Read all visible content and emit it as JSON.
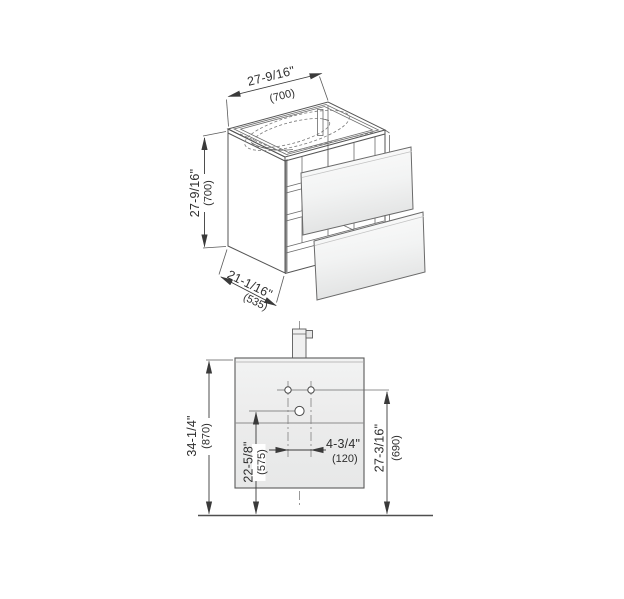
{
  "drawing": {
    "kind": "vanity-unit-technical-drawing",
    "views": {
      "isometric": {
        "width": {
          "inch": "27-9/16\"",
          "mm": "(700)"
        },
        "height": {
          "inch": "27-9/16\"",
          "mm": "(700)"
        },
        "depth": {
          "inch": "21-1/16\"",
          "mm": "(535)"
        }
      },
      "front": {
        "overall_height": {
          "inch": "34-1/4\"",
          "mm": "(870)"
        },
        "outlet_height": {
          "inch": "22-5/8\"",
          "mm": "(575)"
        },
        "tap_hole_spacing": {
          "inch": "4-3/4\"",
          "mm": "(120)"
        },
        "tap_hole_height": {
          "inch": "27-3/16\"",
          "mm": "(690)"
        }
      }
    },
    "colors": {
      "line": "#4a4a4a",
      "text": "#2e2e2e",
      "cabinet_fill": "#ececec",
      "drawer_fill": "#f6f6f6",
      "background": "#ffffff"
    }
  }
}
